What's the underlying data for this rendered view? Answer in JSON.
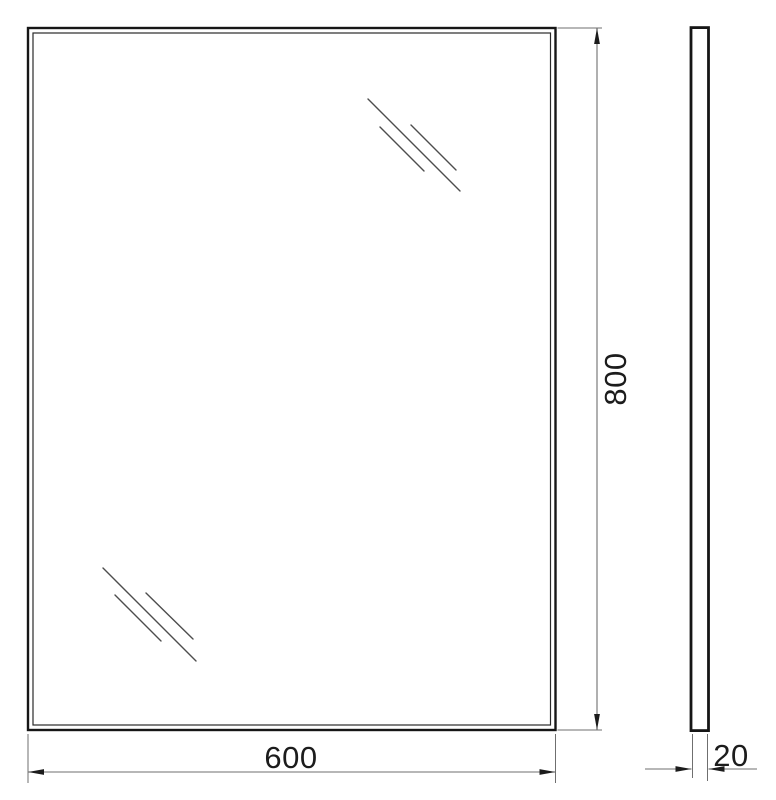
{
  "dimensions": {
    "width": {
      "value": "600"
    },
    "height": {
      "value": "800"
    },
    "depth": {
      "value": "20"
    }
  },
  "colors": {
    "background": "#ffffff",
    "outline": "#161616",
    "inner_line": "#2a2a2a",
    "glare_line": "#4d4d4d",
    "dimension_line": "#6f6f6f",
    "arrow": "#1c1c1c",
    "label_text": "#1c1c1c"
  }
}
